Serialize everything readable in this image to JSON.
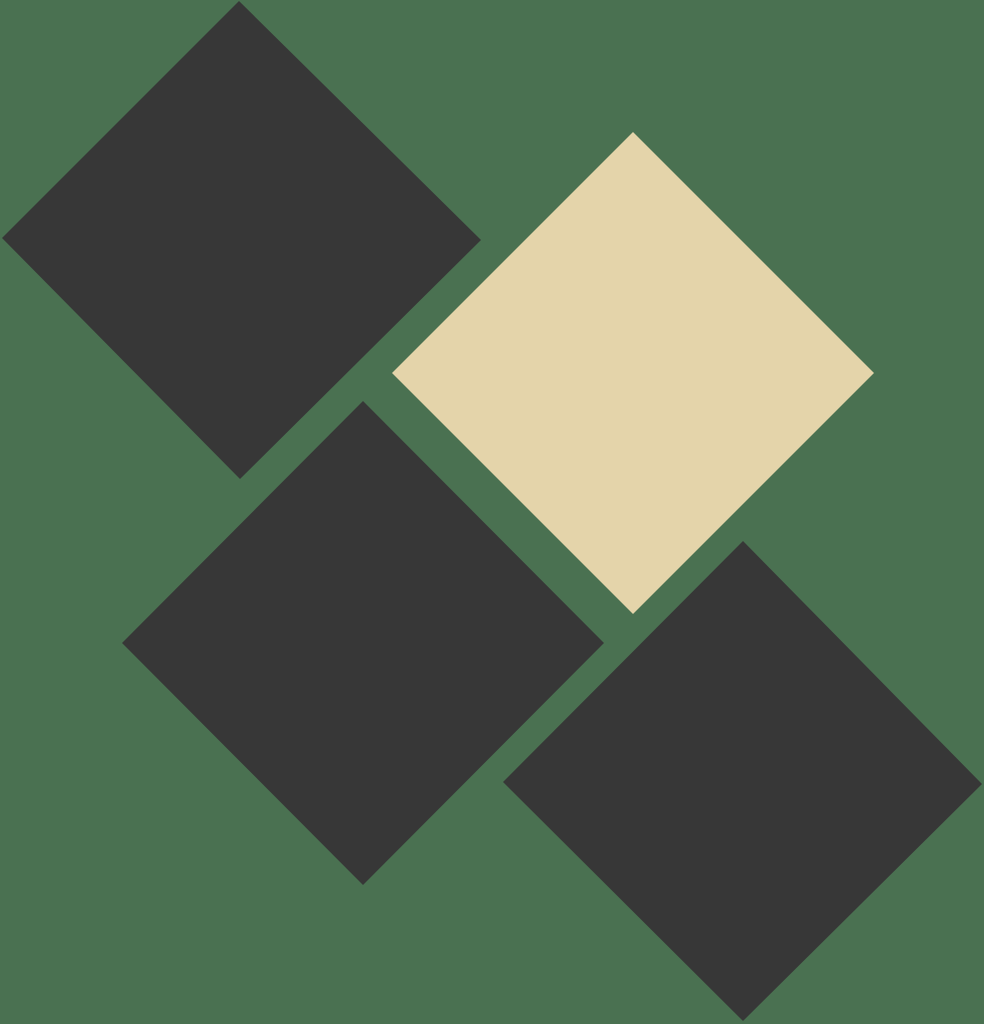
{
  "canvas": {
    "width": 984,
    "height": 1024
  },
  "colors": {
    "background": "#4a7151",
    "dark": "#373737",
    "beige": "#e4d4aa"
  },
  "shapes": [
    {
      "name": "dark-diamond-top-left",
      "color_key": "dark",
      "points": [
        [
          239,
          1
        ],
        [
          481,
          240
        ],
        [
          240,
          479
        ],
        [
          2,
          238
        ]
      ]
    },
    {
      "name": "beige-diamond-top-right",
      "color_key": "beige",
      "points": [
        [
          633,
          132
        ],
        [
          874,
          373
        ],
        [
          633,
          614
        ],
        [
          392,
          373
        ]
      ]
    },
    {
      "name": "dark-diamond-center-left",
      "color_key": "dark",
      "points": [
        [
          363,
          401
        ],
        [
          604,
          643
        ],
        [
          363,
          885
        ],
        [
          122,
          643
        ]
      ]
    },
    {
      "name": "dark-diamond-bottom-right",
      "color_key": "dark",
      "points": [
        [
          743,
          541
        ],
        [
          982,
          784
        ],
        [
          743,
          1021
        ],
        [
          503,
          782
        ]
      ]
    }
  ]
}
